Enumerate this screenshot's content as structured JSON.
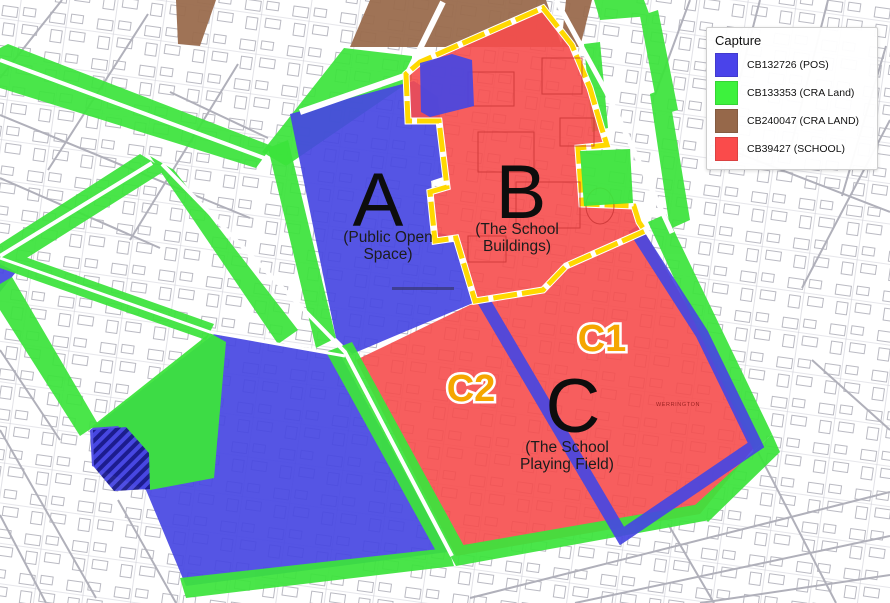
{
  "legend": {
    "title": "Capture",
    "items": [
      {
        "label": "CB132726 (POS)",
        "color_key": "pos_blue"
      },
      {
        "label": "CB133353 (CRA Land)",
        "color_key": "cra_green"
      },
      {
        "label": "CB240047 (CRA LAND)",
        "color_key": "cra_brown"
      },
      {
        "label": "CB39427 (SCHOOL)",
        "color_key": "school_red"
      }
    ]
  },
  "zones": {
    "a": {
      "letter": "A",
      "desc_line1": "(Public Open",
      "desc_line2": "Space)"
    },
    "b": {
      "letter": "B",
      "desc_line1": "(The School",
      "desc_line2": "Buildings)"
    },
    "c": {
      "letter": "C",
      "desc_line1": "(The School",
      "desc_line2": "Playing Field)"
    },
    "c1": {
      "label": "C1"
    },
    "c2": {
      "label": "C2"
    }
  },
  "map_text": {
    "area_name": "WERRINGTON"
  },
  "colors": {
    "pos_blue": "#4a43ea",
    "cra_green": "#3df23d",
    "cra_brown": "#96684a",
    "school_red": "#fa4b4b",
    "map_blue": "#4646e2",
    "map_green": "#3ce43c",
    "map_red": "#f64c4c",
    "map_brown": "#9a6b4d",
    "boundary_yellow": "#ffd800",
    "hatch_navy": "#191989",
    "label_orange": "#f5a600"
  }
}
